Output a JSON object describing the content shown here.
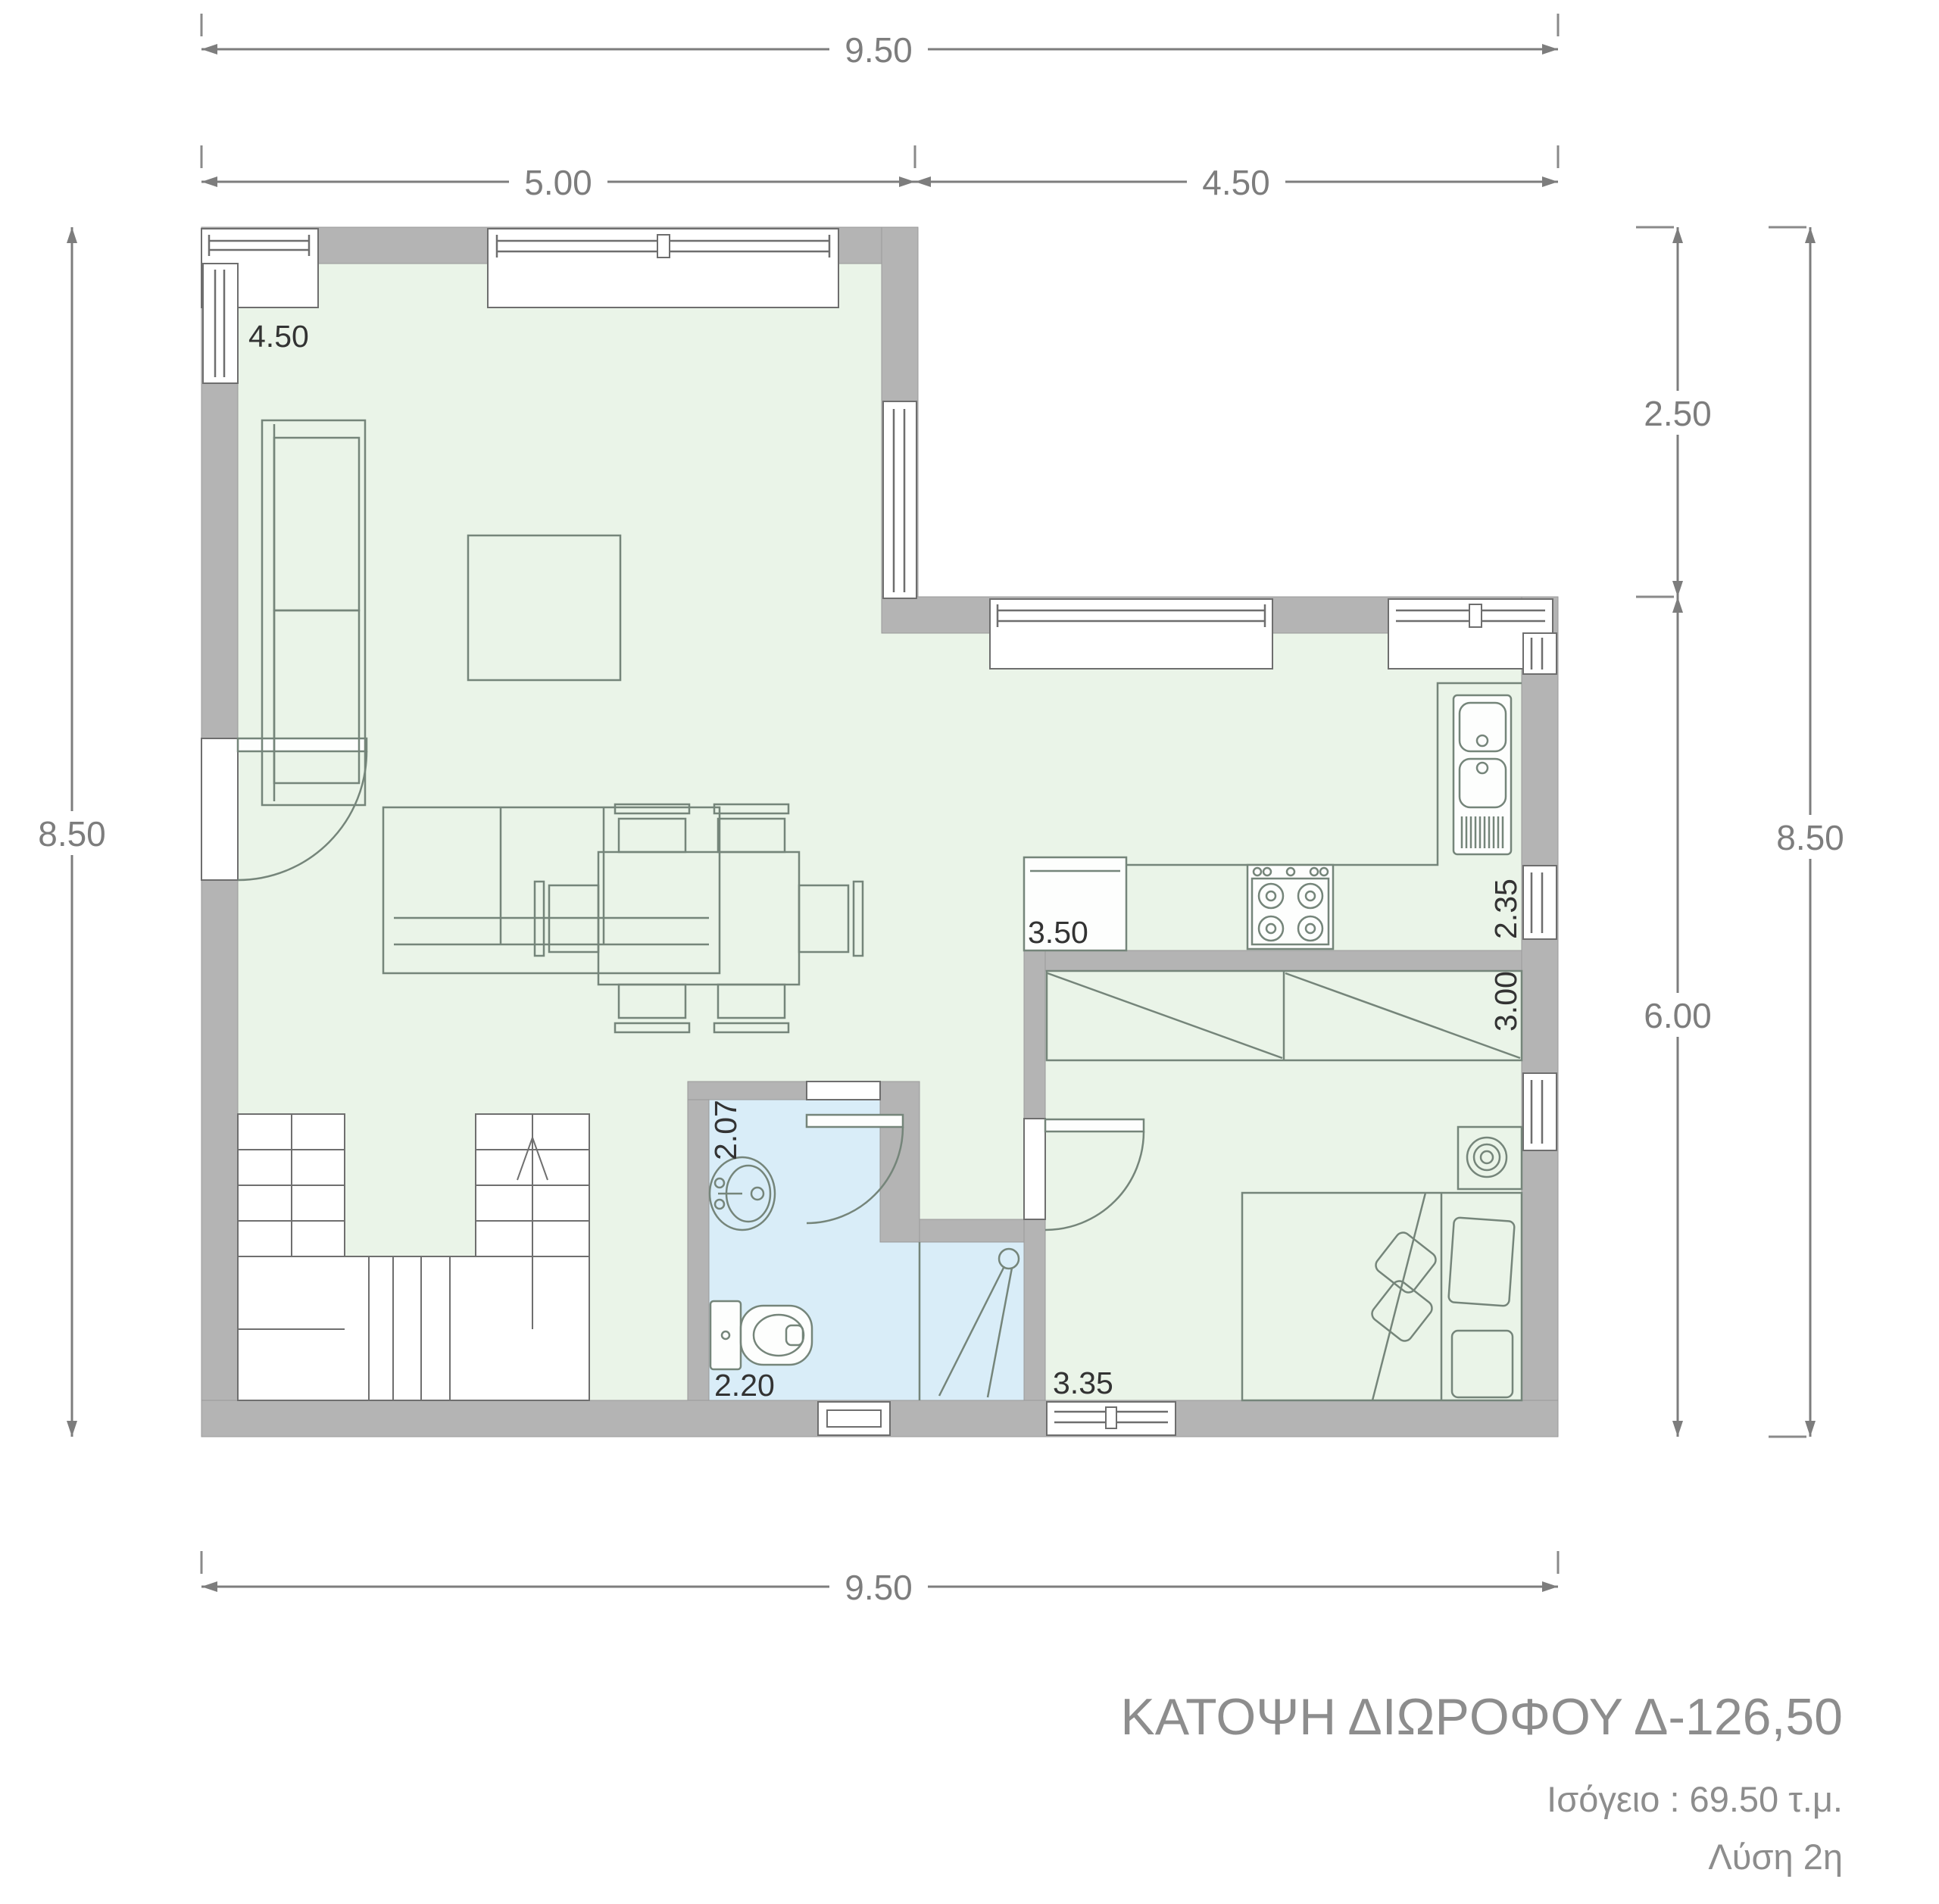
{
  "title_block": {
    "title": "ΚΑΤΟΨΗ ΔΙΩΡΟΦΟΥ Δ-126,50",
    "area_line": "Ισόγειο : 69.50 τ.μ.",
    "solution_line": "Λύση 2η"
  },
  "dimensions": {
    "top_total": "9.50",
    "top_left_span": "5.00",
    "top_right_span": "4.50",
    "left_total": "8.50",
    "right_upper": "2.50",
    "right_lower": "6.00",
    "right_total": "8.50",
    "bottom_total": "9.50"
  },
  "room_labels": {
    "living_width": "4.50",
    "kitchen_width": "3.50",
    "kitchen_depth": "2.35",
    "bedroom_depth": "3.00",
    "bedroom_width": "3.35",
    "bathroom_depth": "2.07",
    "bathroom_width": "2.20"
  },
  "colors": {
    "wall": "#b4b4b4",
    "floor_main": "#eaf4e8",
    "floor_bath": "#d9edf8",
    "furniture_line": "#75857a",
    "dimension": "#7d7d7d",
    "room_label": "#333333",
    "title": "#8d8d8d"
  }
}
